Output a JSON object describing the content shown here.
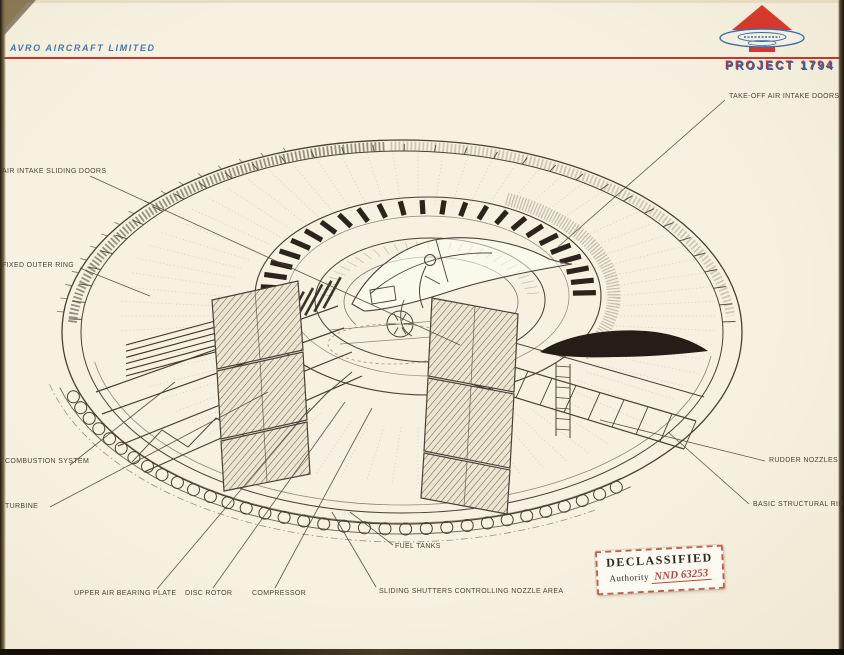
{
  "header": {
    "company": "AVRO AIRCRAFT LIMITED",
    "project": "PROJECT 1794"
  },
  "colors": {
    "accent_red": "#c5372c",
    "brand_blue": "#3a6ea8",
    "ink": "#4a4036",
    "paper": "#f4efe0"
  },
  "diagram": {
    "illustration": "project-1794-saucer-cutaway",
    "labels": [
      {
        "id": "take-off-air-intake-doors",
        "text": "TAKE-OFF AIR INTAKE DOORS",
        "x": 729,
        "y": 93,
        "lead": [
          725,
          100,
          558,
          247
        ]
      },
      {
        "id": "air-intake-sliding-doors",
        "text": "AIR INTAKE SLIDING DOORS",
        "x": 2,
        "y": 168,
        "lead": [
          90,
          176,
          460,
          345
        ]
      },
      {
        "id": "fixed-outer-ring",
        "text": "FIXED OUTER RING",
        "x": 2,
        "y": 262,
        "lead": [
          80,
          268,
          150,
          296
        ]
      },
      {
        "id": "combustion-system",
        "text": "COMBUSTION SYSTEM",
        "x": 5,
        "y": 458,
        "lead": [
          70,
          465,
          175,
          382
        ]
      },
      {
        "id": "turbine",
        "text": "TURBINE",
        "x": 5,
        "y": 503,
        "lead": [
          50,
          507,
          268,
          392
        ]
      },
      {
        "id": "upper-air-bearing-plate",
        "text": "UPPER AIR BEARING PLATE",
        "x": 74,
        "y": 590,
        "lead": [
          157,
          589,
          310,
          408
        ]
      },
      {
        "id": "disc-rotor",
        "text": "DISC ROTOR",
        "x": 185,
        "y": 590,
        "lead": [
          213,
          588,
          345,
          402
        ]
      },
      {
        "id": "compressor",
        "text": "COMPRESSOR",
        "x": 252,
        "y": 590,
        "lead": [
          275,
          588,
          372,
          408
        ]
      },
      {
        "id": "fuel-tanks",
        "text": "FUEL TANKS",
        "x": 395,
        "y": 543,
        "lead": [
          393,
          545,
          350,
          512
        ]
      },
      {
        "id": "sliding-shutters-controlling-nozzle-area",
        "text": "SLIDING SHUTTERS CONTROLLING NOZZLE AREA",
        "x": 379,
        "y": 588,
        "lead": [
          376,
          587,
          332,
          512
        ]
      },
      {
        "id": "rudder-nozzles",
        "text": "RUDDER NOZZLES",
        "x": 769,
        "y": 457,
        "lead": [
          765,
          461,
          600,
          420
        ]
      },
      {
        "id": "basic-structural-ribs",
        "text": "BASIC STRUCTURAL RIBS",
        "x": 753,
        "y": 501,
        "lead": [
          749,
          504,
          668,
          432
        ]
      }
    ]
  },
  "stamp": {
    "title": "DECLASSIFIED",
    "authority_label": "Authority",
    "authority_value": "NND 63253"
  }
}
